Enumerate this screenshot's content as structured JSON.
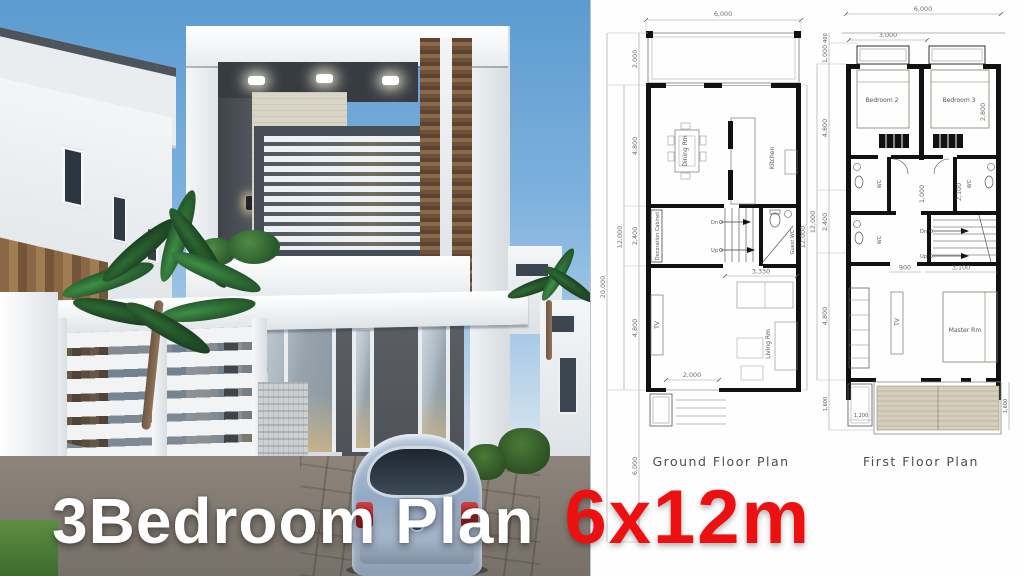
{
  "banner": {
    "white_text": "3Bedroom Plan",
    "red_text": "6x12m",
    "red_color": "#ee1010"
  },
  "ground_plan": {
    "title": "Ground Floor Plan",
    "rooms": {
      "dining": "Dining Rm",
      "kitchen": "Kitchen",
      "decoration_cabinet": "Decoration Cabinet",
      "guest_wc": "Guest WC",
      "living": "Living Rm",
      "tv": "TV"
    },
    "stairs": {
      "down": "Dn",
      "up": "Up"
    },
    "dims": {
      "width_top": "6,000",
      "overall_left": "20,000",
      "house_left": "12,000",
      "seg_terrace": "2,000",
      "seg_dining": "4,800",
      "seg_stairs": "2,400",
      "seg_living": "4,800",
      "seg_yard": "6,000",
      "house_right": "12,000",
      "stair_width": "3,330",
      "door_width": "2,000"
    }
  },
  "first_plan": {
    "title": "First Floor Plan",
    "rooms": {
      "bedroom2": "Bedroom 2",
      "bedroom3": "Bedroom 3",
      "master": "Master Rm",
      "tv": "TV",
      "wc": "WC"
    },
    "stairs": {
      "down": "Dn",
      "up": "Up"
    },
    "dims": {
      "width_top": "6,000",
      "width_sub": "3,000",
      "seg_eave": "400",
      "seg_bay": "1,000",
      "seg_bedrooms": "4,800",
      "seg_stairs": "2,400",
      "seg_master": "4,800",
      "seg_balcony": "1,600",
      "overall_left": "12,000",
      "bed3_width": "2,800",
      "bath_depth": "2,100",
      "corridor": "1,000",
      "landing_a": "900",
      "landing_b": "3,100",
      "planter": "1,200",
      "balcony_right": "1,600"
    }
  }
}
